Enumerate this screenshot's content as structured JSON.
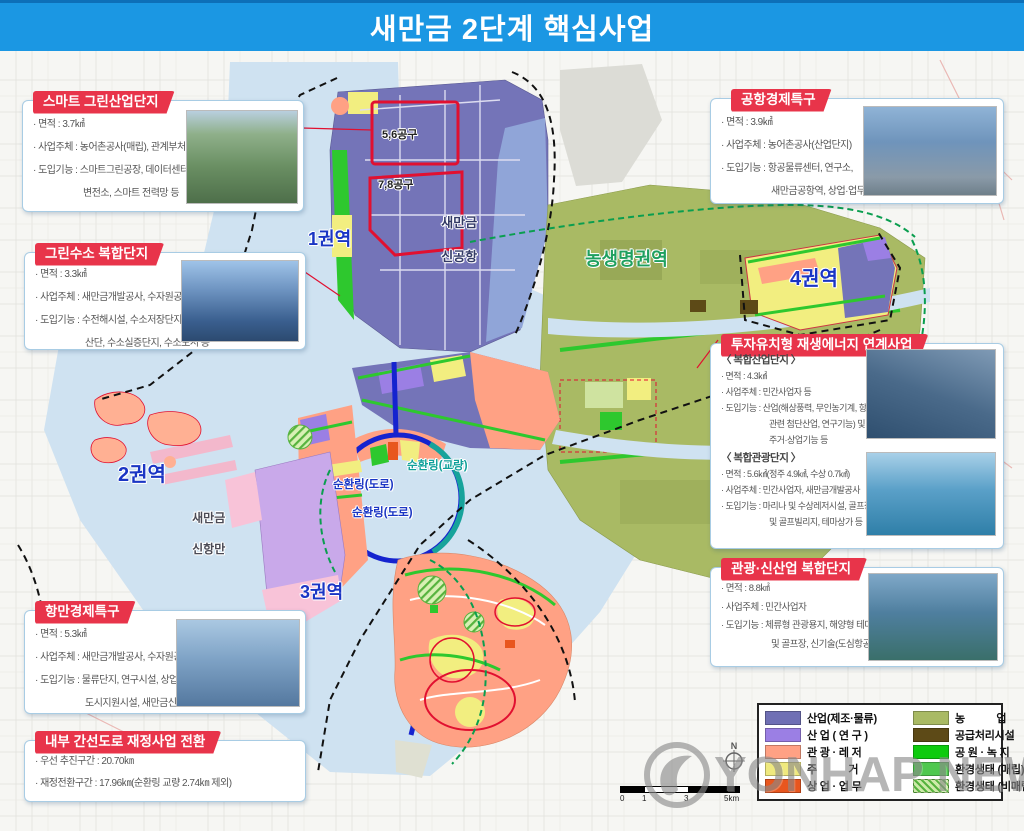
{
  "header": {
    "title": "새만금 2단계 핵심사업",
    "banner_blue": "#1b97e3",
    "ribbon_red": "#e8344a"
  },
  "boxes": [
    {
      "id": "smart-green",
      "title": "스마트 그린산업단지",
      "lines": [
        "· 면적 : 3.7㎢",
        "· 사업주체 : 농어촌공사(매립), 관계부처",
        "· 도입기능 : 스마트그린공장, 데이터센터, 통합",
        "변전소, 스마트 전력망 등"
      ]
    },
    {
      "id": "green-hydrogen",
      "title": "그린수소 복합단지",
      "lines": [
        "· 면적 : 3.3㎢",
        "· 사업주체 : 새만금개발공사, 수자원공사",
        "· 도입기능 : 수전해시설, 수소저장단지, 수소",
        "산단, 수소실증단지, 수소도시 등"
      ]
    },
    {
      "id": "port-zone",
      "title": "항만경제특구",
      "lines": [
        "· 면적 : 5.3㎢",
        "· 사업주체 : 새만금개발공사, 수자원공사",
        "· 도입기능 : 물류단지, 연구시설, 상업·",
        "도시지원시설, 새만금신항역 등"
      ]
    },
    {
      "id": "inner-road",
      "title": "내부 간선도로 재정사업 전환",
      "lines": [
        "· 우선 추진구간 : 20.70㎞",
        "· 재정전환구간 : 17.96㎞(순환링 교량 2.74㎞ 제외)"
      ]
    },
    {
      "id": "airport-zone",
      "title": "공항경제특구",
      "lines": [
        "· 면적 : 3.9㎢",
        "· 사업주체 : 농어촌공사(산업단지)",
        "· 도입기능 : 항공물류센터, 연구소,",
        "새만금공항역, 상업·업무시설 등"
      ]
    },
    {
      "id": "invest-renewable",
      "title": "투자유치형 재생에너지 연계사업",
      "sections": [
        {
          "heading": "〈 복합산업단지 〉",
          "lines": [
            "· 면적 : 4.3㎢",
            "· 사업주체 : 민간사업자 등",
            "· 도입기능 : 산업(해상풍력, 무인농기계, 항공",
            "관련 첨단산업, 연구기능) 및",
            "주거·상업기능 등"
          ]
        },
        {
          "heading": "〈 복합관광단지 〉",
          "lines": [
            "· 면적 : 5.6㎢(정주 4.9㎢, 수상 0.7㎢)",
            "· 사업주체 : 민간사업자, 새만금개발공사",
            "· 도입기능 : 마리나 및 수상레저시설, 골프장",
            "및 골프빌리지, 테마상가 등"
          ]
        }
      ]
    },
    {
      "id": "tourism-newindustry",
      "title": "관광·신산업 복합단지",
      "lines": [
        "· 면적 : 8.8㎢",
        "· 사업주체 : 민간사업자",
        "· 도입기능 : 체류형 관광용지, 해양형 테마파크",
        "및 골프장, 신기술(도심항공) 등"
      ]
    }
  ],
  "map": {
    "labels": {
      "zone1": "1권역",
      "zone2": "2권역",
      "zone3": "3권역",
      "zone4": "4권역",
      "agri": "농생명권역",
      "airport_l1": "새만금",
      "airport_l2": "신공항",
      "port_l1": "새만금",
      "port_l2": "신항만",
      "district56": "5,6공구",
      "district78": "7,8공구",
      "ring_road": "순환링(도로)",
      "ring_bridge": "순환링(교량)"
    }
  },
  "legend": {
    "left": [
      {
        "label": "산업(제조·물류)",
        "color": "#6f6fb4"
      },
      {
        "label": "산 업 ( 연 구 )",
        "color": "#9b7fe4"
      },
      {
        "label": "관 광 · 레 저",
        "color": "#ffa184"
      },
      {
        "label": "주           거",
        "color": "#efe97e"
      },
      {
        "label": "상 업 · 업 무",
        "color": "#e8561e"
      }
    ],
    "right": [
      {
        "label": "농           업",
        "color": "#a9ba64"
      },
      {
        "label": "공급처리시설",
        "color": "#5d4a17"
      },
      {
        "label": "공 원 · 녹 지",
        "color": "#0ecb0e"
      },
      {
        "label": "환경생태 (매립)",
        "color": "#4fc84f"
      },
      {
        "label": "환경생태 (비매립)",
        "color": "#cdeaa8"
      }
    ]
  },
  "scalebar": {
    "ticks": [
      "0",
      "1",
      "3",
      "5km"
    ]
  },
  "compass": {
    "n": "N"
  },
  "watermark": {
    "text": "YONHAP NEWS"
  }
}
